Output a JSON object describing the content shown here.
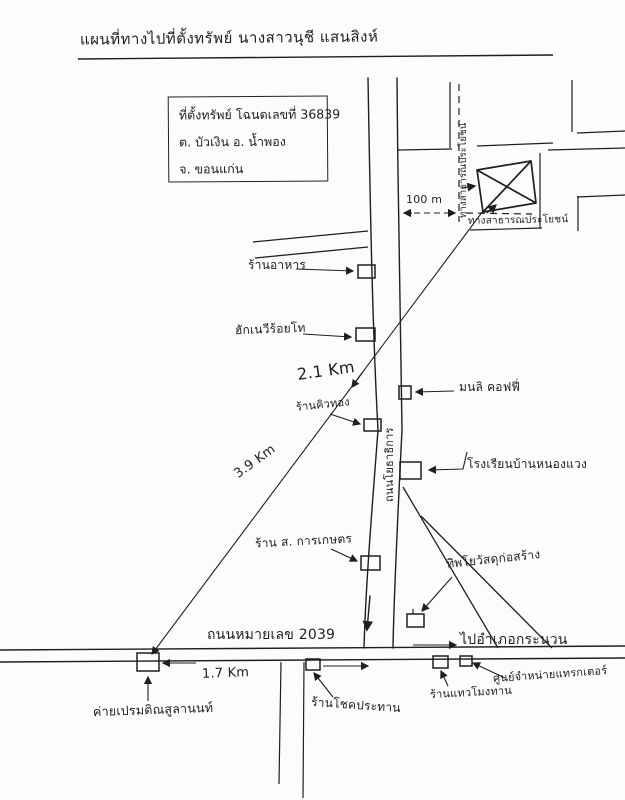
{
  "labels": {
    "title": "แผนที่ทางไปที่ตั้งทรัพย์ นางสาวนุชี แสนสิงห์",
    "public_way_vertical": "ทางสาธารณประโยชน์",
    "public_way_horizontal": "ทางสาธารณประโยชน์",
    "scale_100m": "100 m",
    "restaurant": "ร้านอาหาร",
    "hug_navy_shop": "ฮักเนวีร้อยโท",
    "dist_2_1km": "2.1 Km",
    "khiu_thong_shop": "ร้านคิวทอง",
    "monli_coffee": "มนลิ คอฟฟี่",
    "nong_waeng_school": "โรงเรียนบ้านหนองแวง",
    "yothathikan_road": "ถนนโยธาธิการ",
    "dist_3_9km": "3.9 Km",
    "s_kankaset_shop": "ร้าน ส. การเกษตร",
    "construction_shop": "ทิพโยวัสดุก่อสร้าง",
    "highway_2039": "ถนนหมายเลข 2039",
    "to_kranuan": "ไปอำเภอกระนวน",
    "dist_1_7km": "1.7 Km",
    "camp_prem": "ค่ายเปรมติณสูลานนท์",
    "chok_prathan_shop": "ร้านโชคประทาน",
    "thaew_mong_shop": "ร้านแทวโมงทาน",
    "tractor_center": "ศูนย์จำหน่ายแทรกเตอร์"
  },
  "info_box": {
    "line1": "ที่ตั้งทรัพย์ โฉนดเลขที่ 36839",
    "line2": "ต. บัวเงิน อ. น้ำพอง",
    "line3": "จ. ขอนแก่น"
  },
  "colors": {
    "ink": "#1f1f1f",
    "paper": "#fcfcfa"
  }
}
